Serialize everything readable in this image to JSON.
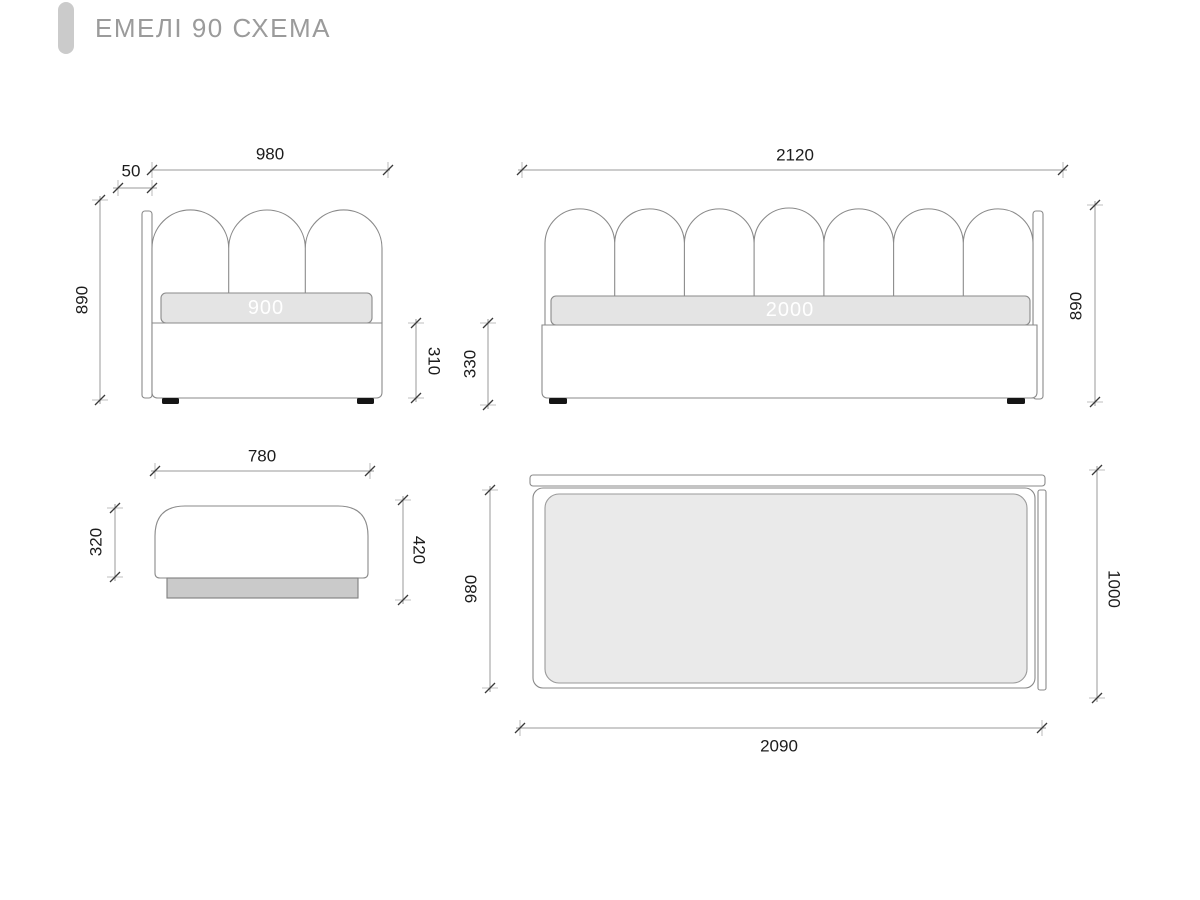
{
  "title": "ЕМЕЛІ 90 СХЕМА",
  "front_view": {
    "width": "980",
    "panel_thickness": "50",
    "height": "890",
    "base_height": "310",
    "mattress_width": "900"
  },
  "side_view": {
    "length": "2120",
    "height": "890",
    "base_height": "330",
    "mattress_length": "2000"
  },
  "ottoman_view": {
    "width": "780",
    "body_height": "320",
    "total_height": "420"
  },
  "top_view": {
    "inner_width": "980",
    "total_width": "1000",
    "length": "2090"
  },
  "colors": {
    "background": "#ffffff",
    "outline_gray": "#8a8a8a",
    "dimension_line": "#9a9a9a",
    "tick_mark": "#3a3a3a",
    "mattress_fill": "#e4e4e4",
    "top_mattress_fill": "#eaeaea",
    "ottoman_base_fill": "#cacaca",
    "feet_black": "#151515",
    "dim_text": "#1c1c1c",
    "title_gray": "#9b9b9b",
    "accent_bar": "#cbcbcb"
  }
}
